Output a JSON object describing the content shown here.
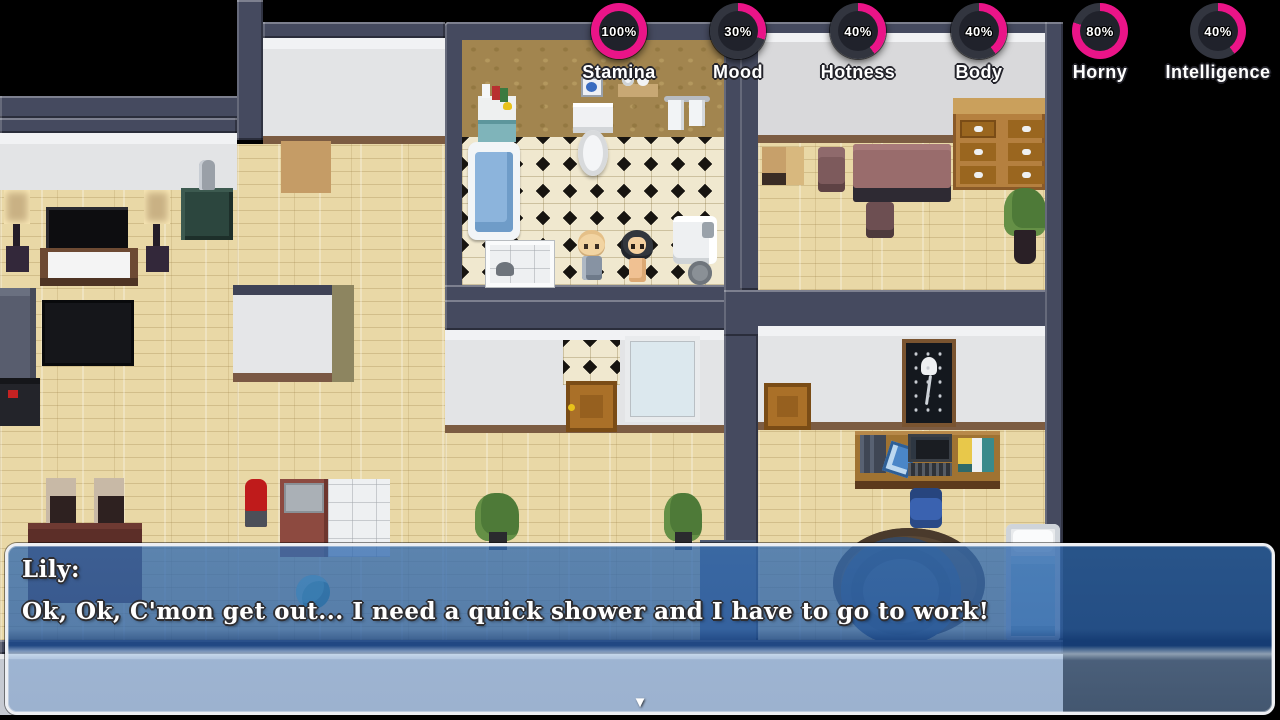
{
  "hud": {
    "ring_color": "#ea1488",
    "ring_track": "#32353f",
    "stats": [
      {
        "label": "Stamina",
        "percent": 100,
        "display": "100%"
      },
      {
        "label": "Mood",
        "percent": 30,
        "display": "30%"
      },
      {
        "label": "Hotness",
        "percent": 40,
        "display": "40%"
      },
      {
        "label": "Body",
        "percent": 40,
        "display": "40%"
      },
      {
        "label": "Horny",
        "percent": 80,
        "display": "80%"
      },
      {
        "label": "Intelligence",
        "percent": 40,
        "display": "40%"
      }
    ]
  },
  "dialog": {
    "speaker": "Lily:",
    "line": "Ok, Ok, C'mon get out... I need a quick shower and I have to go to work!",
    "continue_indicator": "▼"
  },
  "colors": {
    "dialog_blue": "#2e64aa",
    "dialog_border": "#edeff3",
    "wall_slate": "#454a5f",
    "floor_wood": "#e9d8a6",
    "bath_wall_tan": "#a2854f"
  }
}
